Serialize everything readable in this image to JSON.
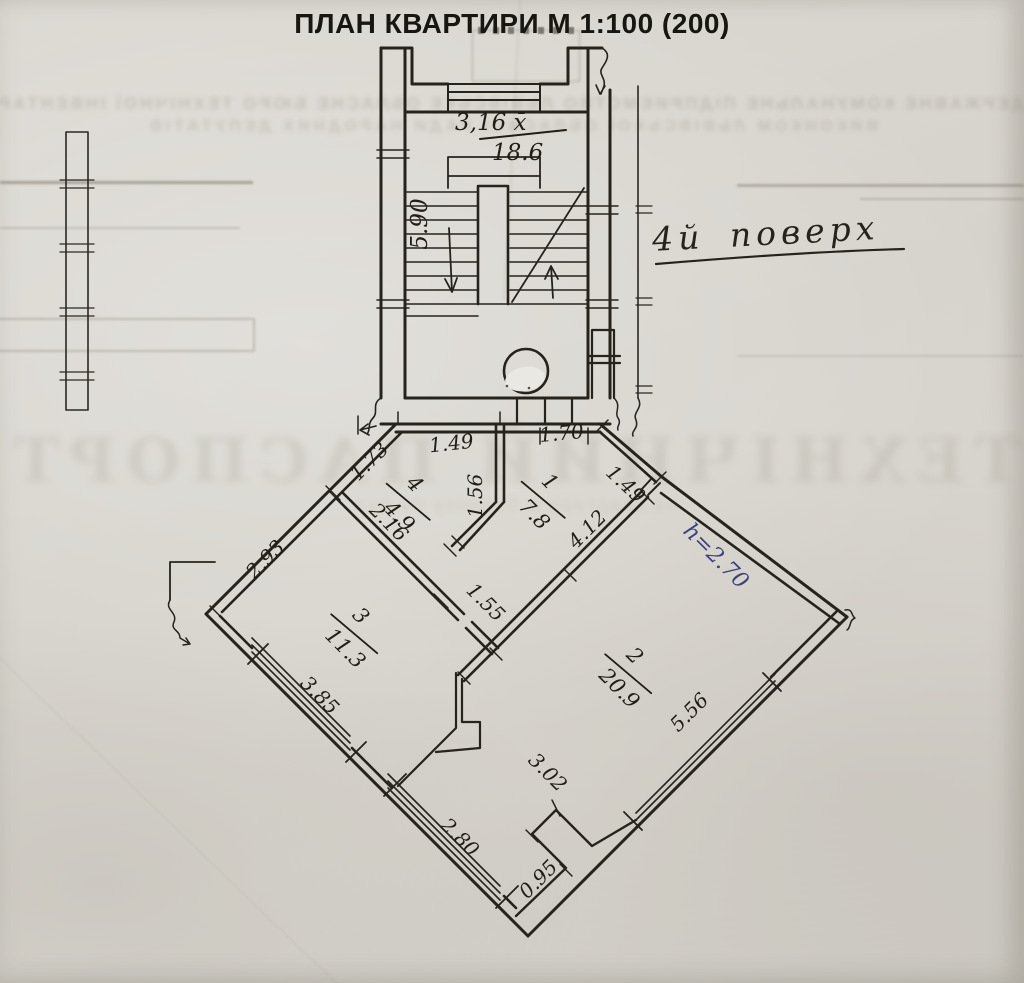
{
  "document": {
    "title": "ПЛАН КВАРТИРИ М 1:100 (200)",
    "floor_note": "4й поверх"
  },
  "stairwell": {
    "width_label": "3,16 х̄",
    "area_label": "18.6",
    "flight_label": "5.90"
  },
  "rooms": {
    "room1": {
      "number": "1",
      "area": "7.8"
    },
    "room2": {
      "number": "2",
      "area": "20.9"
    },
    "room3": {
      "number": "3",
      "area": "11.3"
    },
    "room4": {
      "number": "4",
      "area": "4.9"
    }
  },
  "dimensions": {
    "d_1_73": "1.73",
    "d_1_49_top": "1.49",
    "d_1_56": "1.56",
    "d_1_70": "1.70",
    "d_1_49_right": "1.49",
    "d_4_12": "4.12",
    "d_2_16": "2.16",
    "d_1_55": "1.55",
    "d_2_93": "2.93",
    "d_3_85": "3.85",
    "d_5_56": "5.56",
    "d_3_02": "3.02",
    "d_2_80": "2.80",
    "d_0_95": "0.95",
    "height_note": "h=2.70"
  },
  "colors": {
    "ink": "#23201a",
    "blue_ink": "#3e4080",
    "paper": "#d8d5ce",
    "ghost": "#8b8578"
  },
  "ghost_text": {
    "top_line_1": "ДЕРЖАВНЕ КОМУНАЛЬНЕ ПІДПРИЄМСТВО ЛЬВІВСЬКЕ ОБЛАСНЕ БЮРО ТЕХНІЧНОЇ ІНВЕНТАРИЗАЦІЇ",
    "top_line_2": "ВИКОНКОМ ЛЬВІВСЬКОЇ ОБЛАСНОЇ РАДИ НАРОДНИХ ДЕПУТАТІВ",
    "big_line": "ТЕХНІЧНИЙ ПАСПОРТ",
    "sub_line": "на квартиру в будинку по вул."
  }
}
